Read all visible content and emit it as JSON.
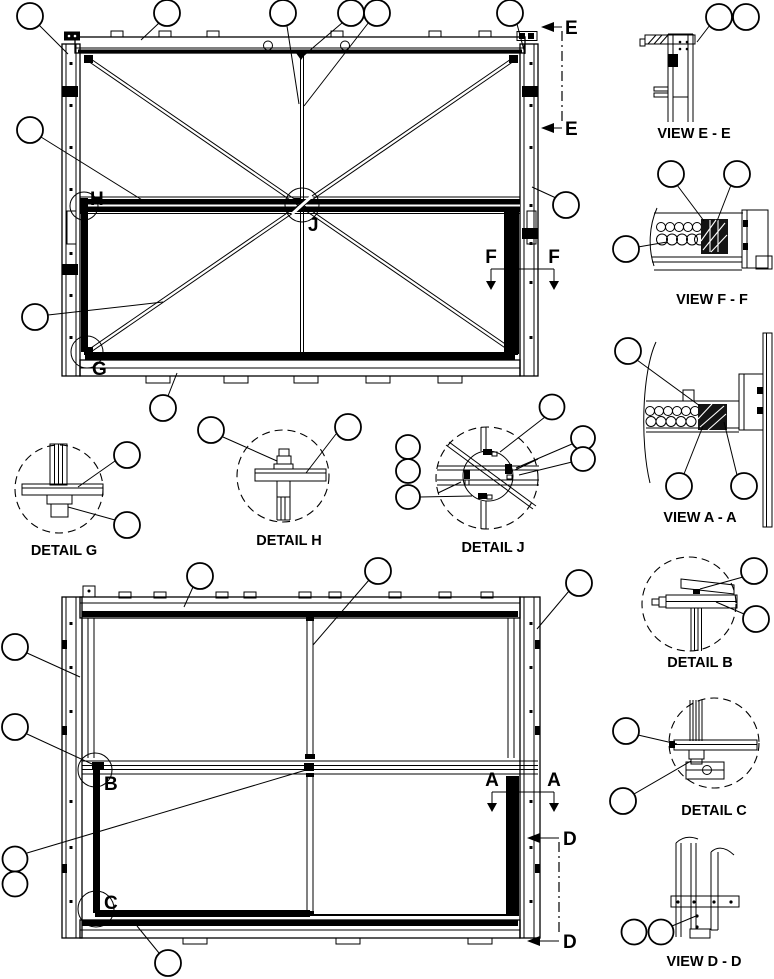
{
  "page": {
    "background": "#ffffff",
    "ink": "#000000"
  },
  "figure": {
    "type": "technical-parts-line-drawing",
    "description": "Assembly drawing of a rectangular frame unit shown in two elevations with cross-braced panel, plus section views and enlarged details; empty callout balloons point to parts"
  },
  "views": {
    "view_ee_label": "VIEW E - E",
    "view_ff_label": "VIEW F - F",
    "view_aa_label": "VIEW A - A",
    "view_dd_label": "VIEW D - D",
    "detail_g_label": "DETAIL G",
    "detail_h_label": "DETAIL H",
    "detail_j_label": "DETAIL J",
    "detail_b_label": "DETAIL B",
    "detail_c_label": "DETAIL C"
  },
  "markers": {
    "detail_h_ref": "H",
    "detail_g_ref": "G",
    "detail_j_ref": "J",
    "detail_b_ref": "B",
    "detail_c_ref": "C",
    "section_e": "E",
    "section_f": "F",
    "section_a": "A",
    "section_d": "D"
  }
}
